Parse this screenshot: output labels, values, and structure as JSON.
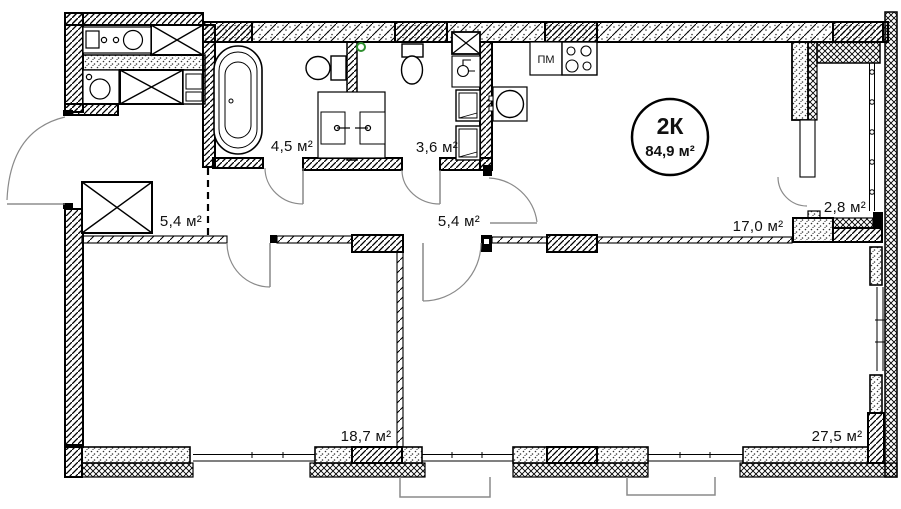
{
  "plan": {
    "title_badge": {
      "type": "2К",
      "area": "84,9 м²"
    },
    "labels": {
      "bathroom": "4,5 м²",
      "wc": "3,6 м²",
      "hall_entry": "5,4 м²",
      "hall_inner": "5,4 м²",
      "kitchen_living": "17,0 м²",
      "balcony": "2,8 м²",
      "bedroom": "18,7 м²",
      "living_room": "27,5 м²",
      "dishwasher": "ПМ"
    },
    "colors": {
      "line": "#000000",
      "door_arc": "#8a8a8a",
      "balcony_outline": "#8a8a8a",
      "vent_marker": "#2f8f2f",
      "background": "#ffffff"
    }
  }
}
